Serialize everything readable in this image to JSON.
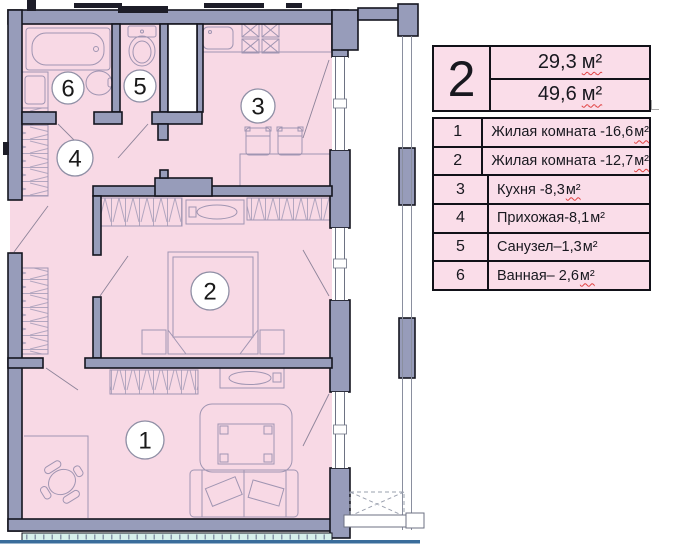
{
  "unit_summary": {
    "unit_number": "2",
    "living_area": "29,3",
    "total_area": "49,6",
    "area_unit": "м²"
  },
  "legend": {
    "rows": [
      {
        "num": "1",
        "label": "Жилая комната -16,6",
        "unit": "м²"
      },
      {
        "num": "2",
        "label": "Жилая комната -12,7",
        "unit": "м²"
      },
      {
        "num": "3",
        "label": "Кухня -8,3",
        "unit": "м²"
      },
      {
        "num": "4",
        "label": "Прихожая-8,1",
        "unit": "м²"
      },
      {
        "num": "5",
        "label": "Санузел–1,3",
        "unit": "м²"
      },
      {
        "num": "6",
        "label": "Ванная– 2,6",
        "unit": "м²"
      }
    ]
  },
  "plan": {
    "rooms": [
      {
        "num": "1"
      },
      {
        "num": "2"
      },
      {
        "num": "3"
      },
      {
        "num": "4"
      },
      {
        "num": "5"
      },
      {
        "num": "6"
      }
    ]
  },
  "colors": {
    "room_fill": "#f8d9e5",
    "table_fill": "#fadde9",
    "wall_fill": "#979cba",
    "outline": "#15151f",
    "furniture_stroke": "#a095b2",
    "balcony_tint": "#d7f0ec",
    "page_rule": "#3a6d9b",
    "squiggle_red": "#e04040"
  }
}
